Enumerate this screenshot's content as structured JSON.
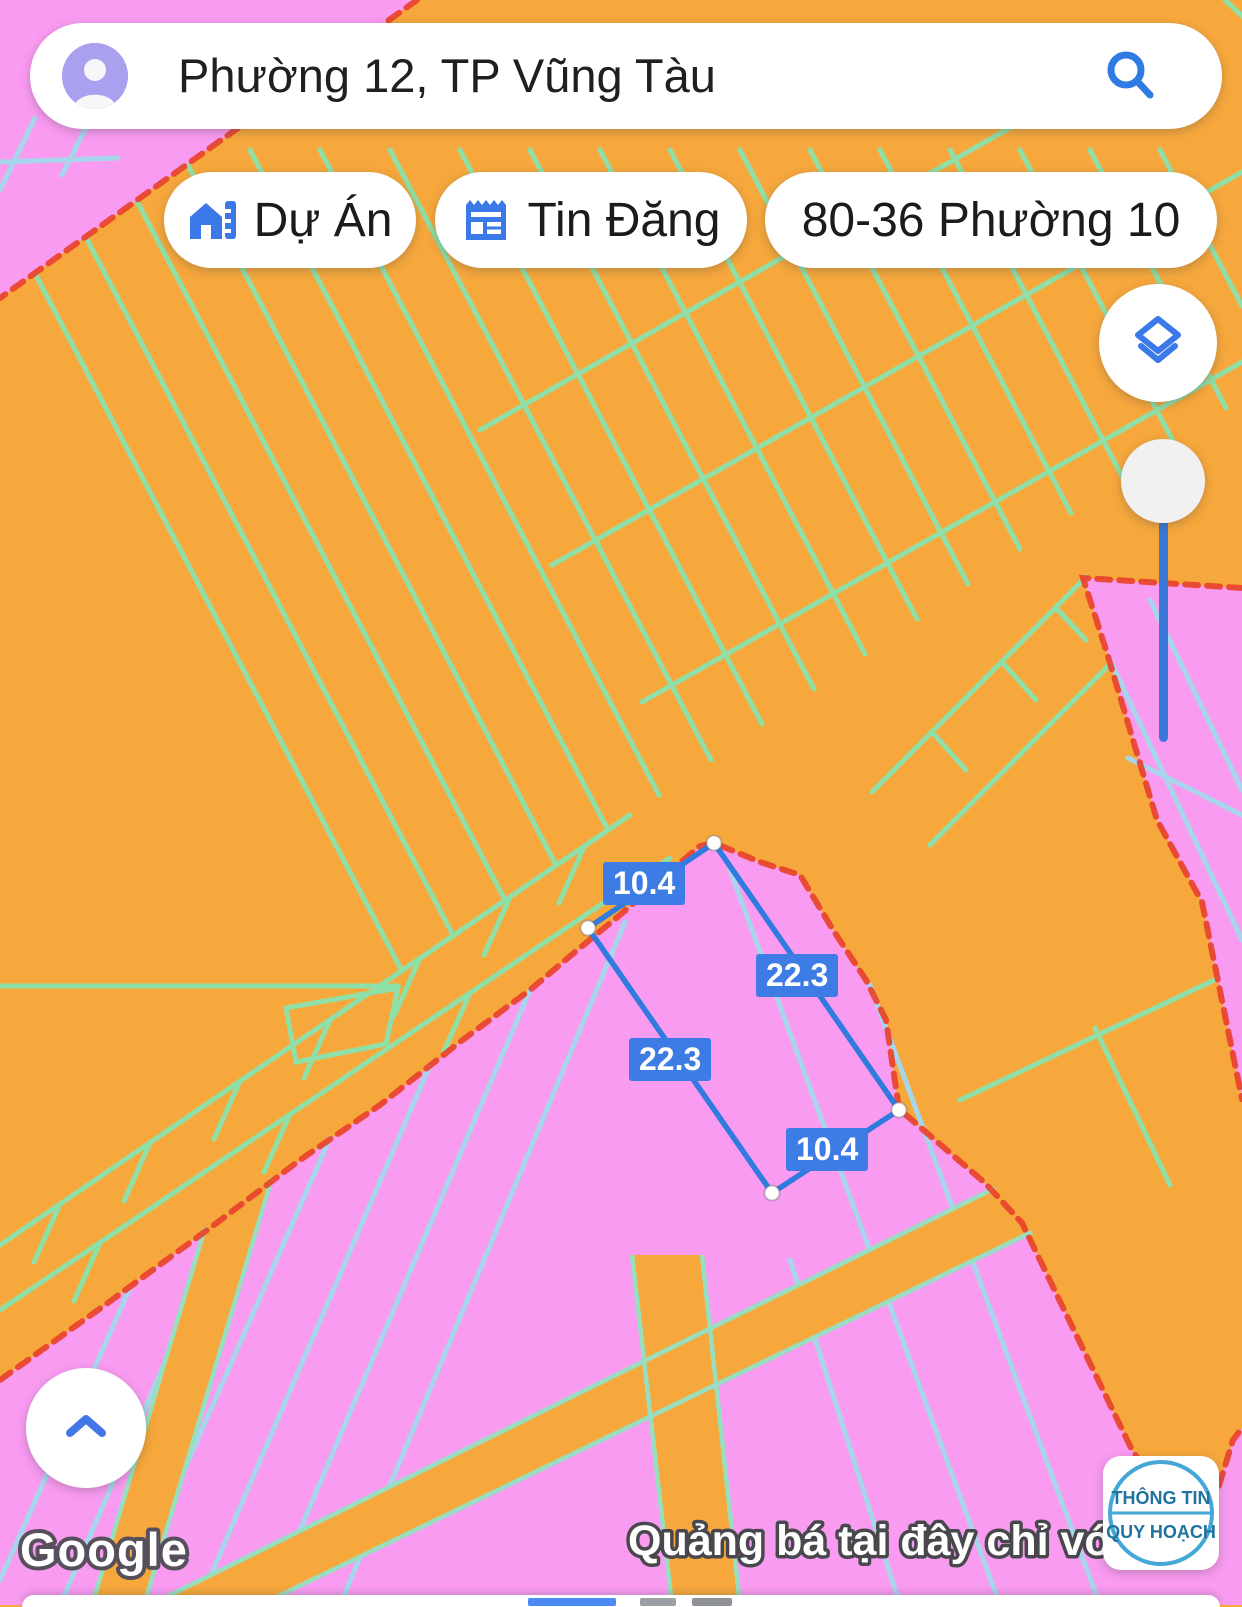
{
  "colors": {
    "map_orange": "#F7A83C",
    "map_pink": "#FA9BF2",
    "parcel_line_on_orange": "#8FE0A8",
    "parcel_line_on_pink": "#A7D6EC",
    "zone_border_red": "#E8432C",
    "accent_blue": "#3B78E8",
    "measure_blue": "#2F7BDE",
    "label_bg_blue": "#3D7BE5",
    "slider_track_blue": "#3C78D8",
    "badge_blue": "#44A7D6",
    "badge_text_blue": "#21739F"
  },
  "search": {
    "query": "Phường 12, TP Vũng Tàu"
  },
  "chips": {
    "du_an": "Dự Án",
    "tin_dang": "Tin Đăng",
    "address": "80-36 Phường 10"
  },
  "measurement": {
    "top": "10.4",
    "right": "22.3",
    "left": "22.3",
    "bottom": "10.4"
  },
  "watermark": "Google",
  "ad_text": "Quảng bá tại đây chỉ vớ",
  "badge": {
    "line1": "THÔNG TIN",
    "line2": "QUY HOẠCH"
  }
}
